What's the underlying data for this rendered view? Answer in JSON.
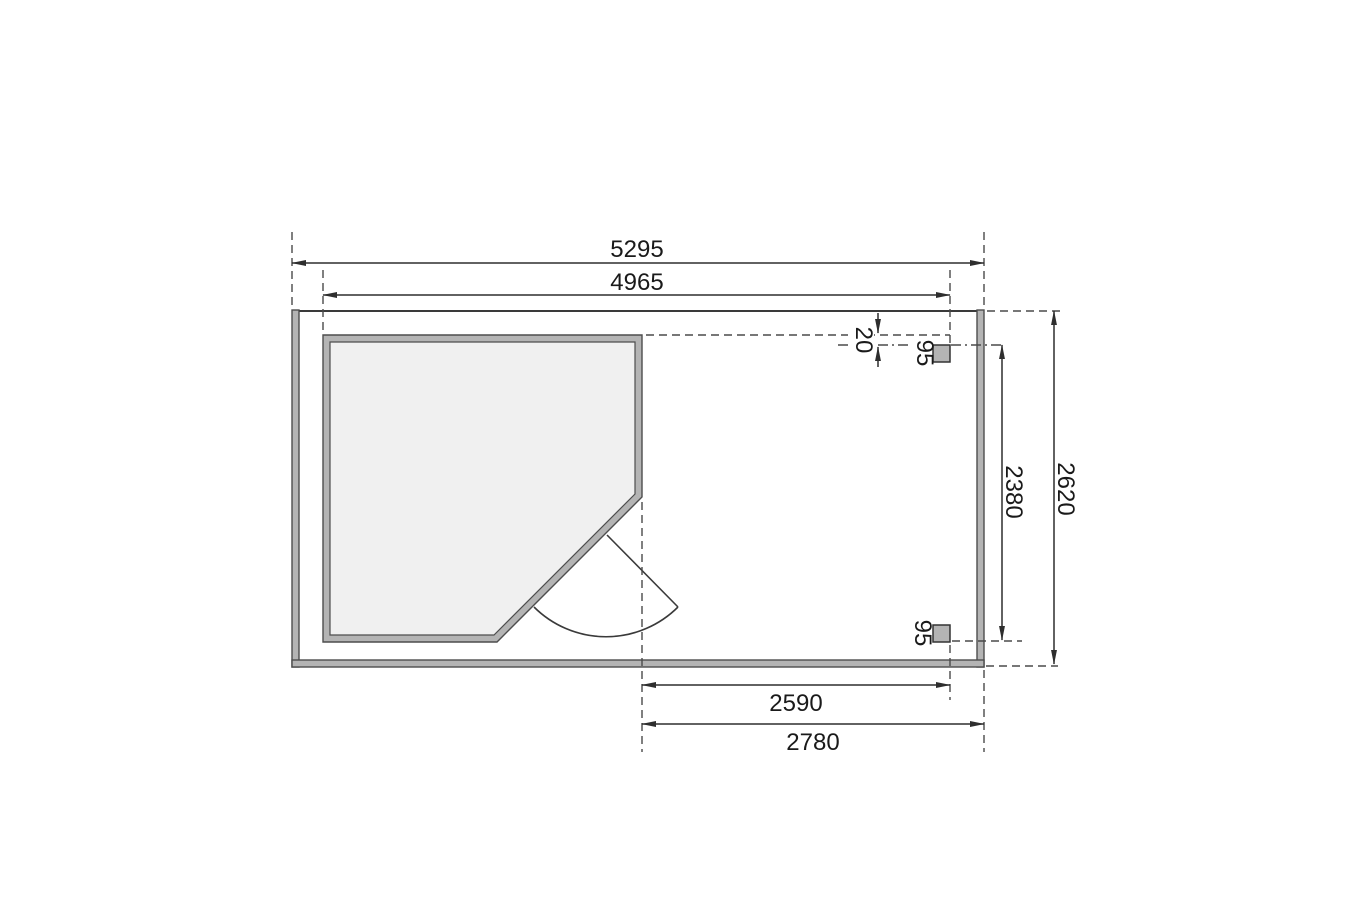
{
  "plan": {
    "background": "#ffffff",
    "line_color": "#3a3a3a",
    "wall_fill": "#b4b4b4",
    "room_fill": "#f0f0f0",
    "post_fill": "#b4b4b4",
    "dims": {
      "overall_width": "5295",
      "wall_outer_width": "4965",
      "overhang_gap": "20",
      "post_top": "95",
      "post_bottom": "95",
      "posts_span": "2380",
      "overall_depth": "2620",
      "annex_width_inner": "2590",
      "annex_width_outer": "2780"
    }
  }
}
